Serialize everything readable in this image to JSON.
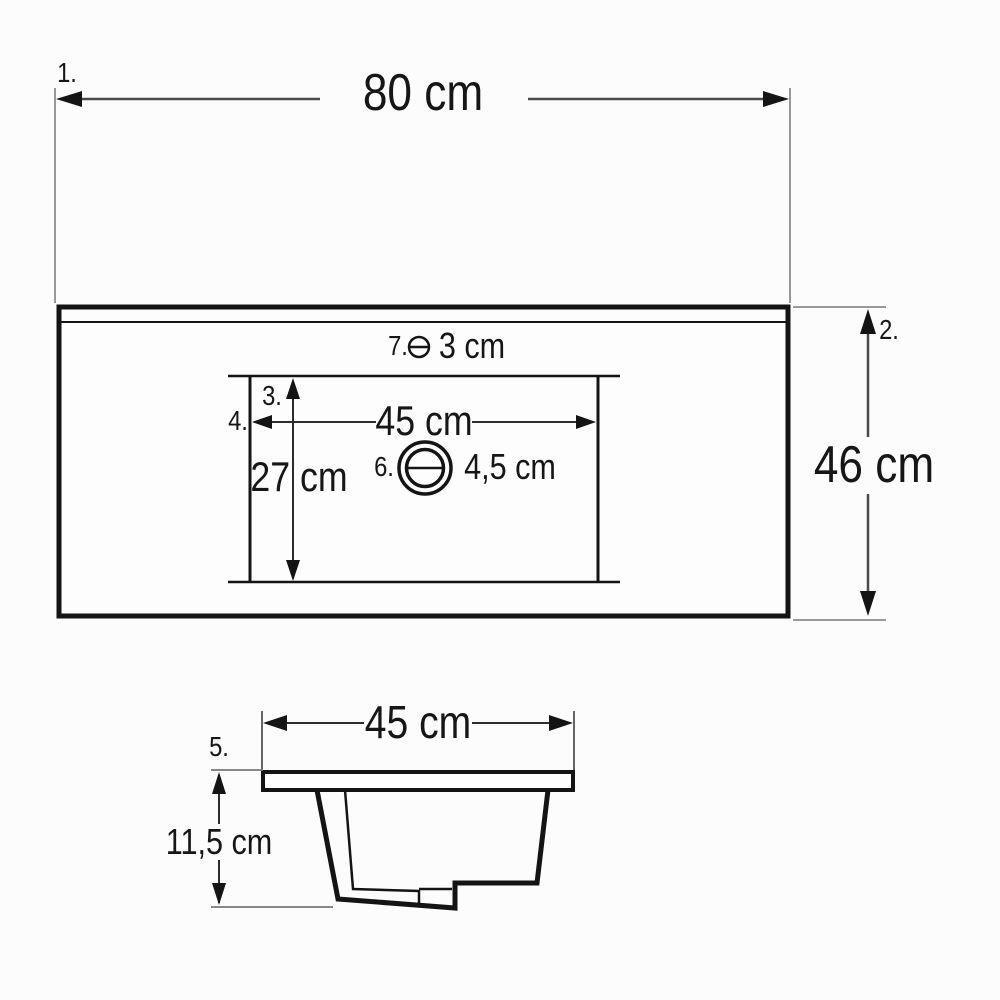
{
  "meta": {
    "drawing_type": "washbasin dimension diagram",
    "unit": "cm",
    "views": [
      "top view",
      "side section view"
    ]
  },
  "colors": {
    "background": "#fcfcfc",
    "object_line": "#141414",
    "dimension_line": "#4a4a4a",
    "extension_line": "#999999",
    "text": "#161616"
  },
  "top_view": {
    "ref_marker_1": "1.",
    "overall_width_label": "80 cm",
    "ref_marker_2": "2.",
    "overall_depth_label": "46 cm",
    "ref_marker_7": "7.",
    "faucet_hole_diameter_label": "3 cm",
    "ref_marker_3": "3.",
    "ref_marker_4": "4.",
    "basin_width_label": "45 cm",
    "basin_depth_label": "27 cm",
    "ref_marker_6": "6.",
    "drain_diameter_label": "4,5 cm"
  },
  "side_view": {
    "ref_marker_5": "5.",
    "basin_width_label": "45 cm",
    "basin_height_label": "11,5 cm"
  },
  "icons": {
    "faucet_hole_icon": "circle-with-horizontal-line",
    "drain_icon": "concentric-circles-with-horizontal-line"
  }
}
